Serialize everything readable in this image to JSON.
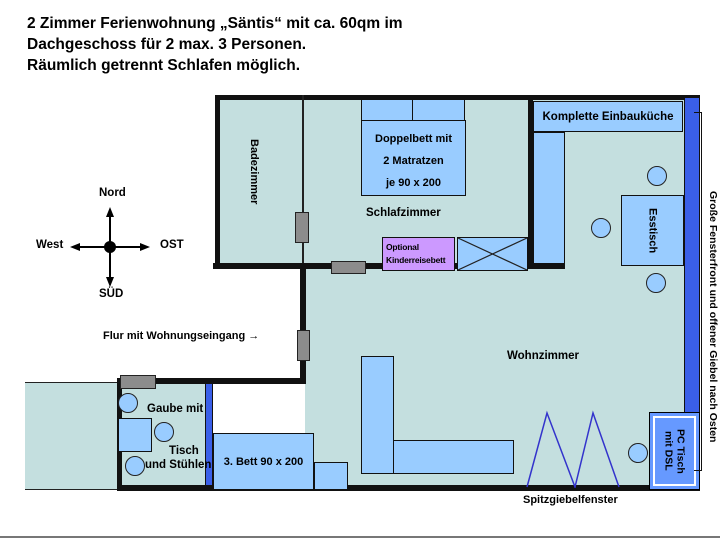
{
  "title": {
    "line1": "2 Zimmer Ferienwohnung „Säntis“ mit ca. 60qm im",
    "line2": "Dachgeschoss für 2 max. 3 Personen.",
    "line3": "Räumlich getrennt Schlafen möglich."
  },
  "compass": {
    "north": "Nord",
    "east": "OST",
    "south": "SÜD",
    "west": "West"
  },
  "rooms": {
    "bathroom": "Badezimmer",
    "bedroom": "Schlafzimmer",
    "living": "Wohnzimmer",
    "hall": "Flur mit Wohnungseingang →"
  },
  "furniture": {
    "double_bed": {
      "line1": "Doppelbett mit",
      "line2": "2 Matratzen",
      "line3": "je 90 x 200"
    },
    "kitchen": "Komplette Einbauküche",
    "dining_table": "Esstisch",
    "crib": {
      "line1": "Optional",
      "line2": "Kinderreisebett"
    },
    "third_bed": "3. Bett 90 x 200",
    "pc_desk": {
      "line1": "PC Tisch",
      "line2": "mit DSL"
    }
  },
  "annotations": {
    "dormer_line1": "Gaube mit",
    "dormer_line2": "Tisch",
    "dormer_line3": "und Stühlen",
    "gable_window": "Spitzgiebelfenster",
    "window_front": "Große Fensterfront und offener Giebel nach Osten"
  },
  "colors": {
    "room-fill": "#C4DFDF",
    "furniture-fill": "#99CCFF",
    "window-blue": "#3A5FE8",
    "crib-violet": "#CC99FF",
    "door-gray": "#8C8C8C",
    "pc-desk-blue": "#6699FF",
    "window-line": "#3333CC",
    "wall-black": "#111111"
  }
}
